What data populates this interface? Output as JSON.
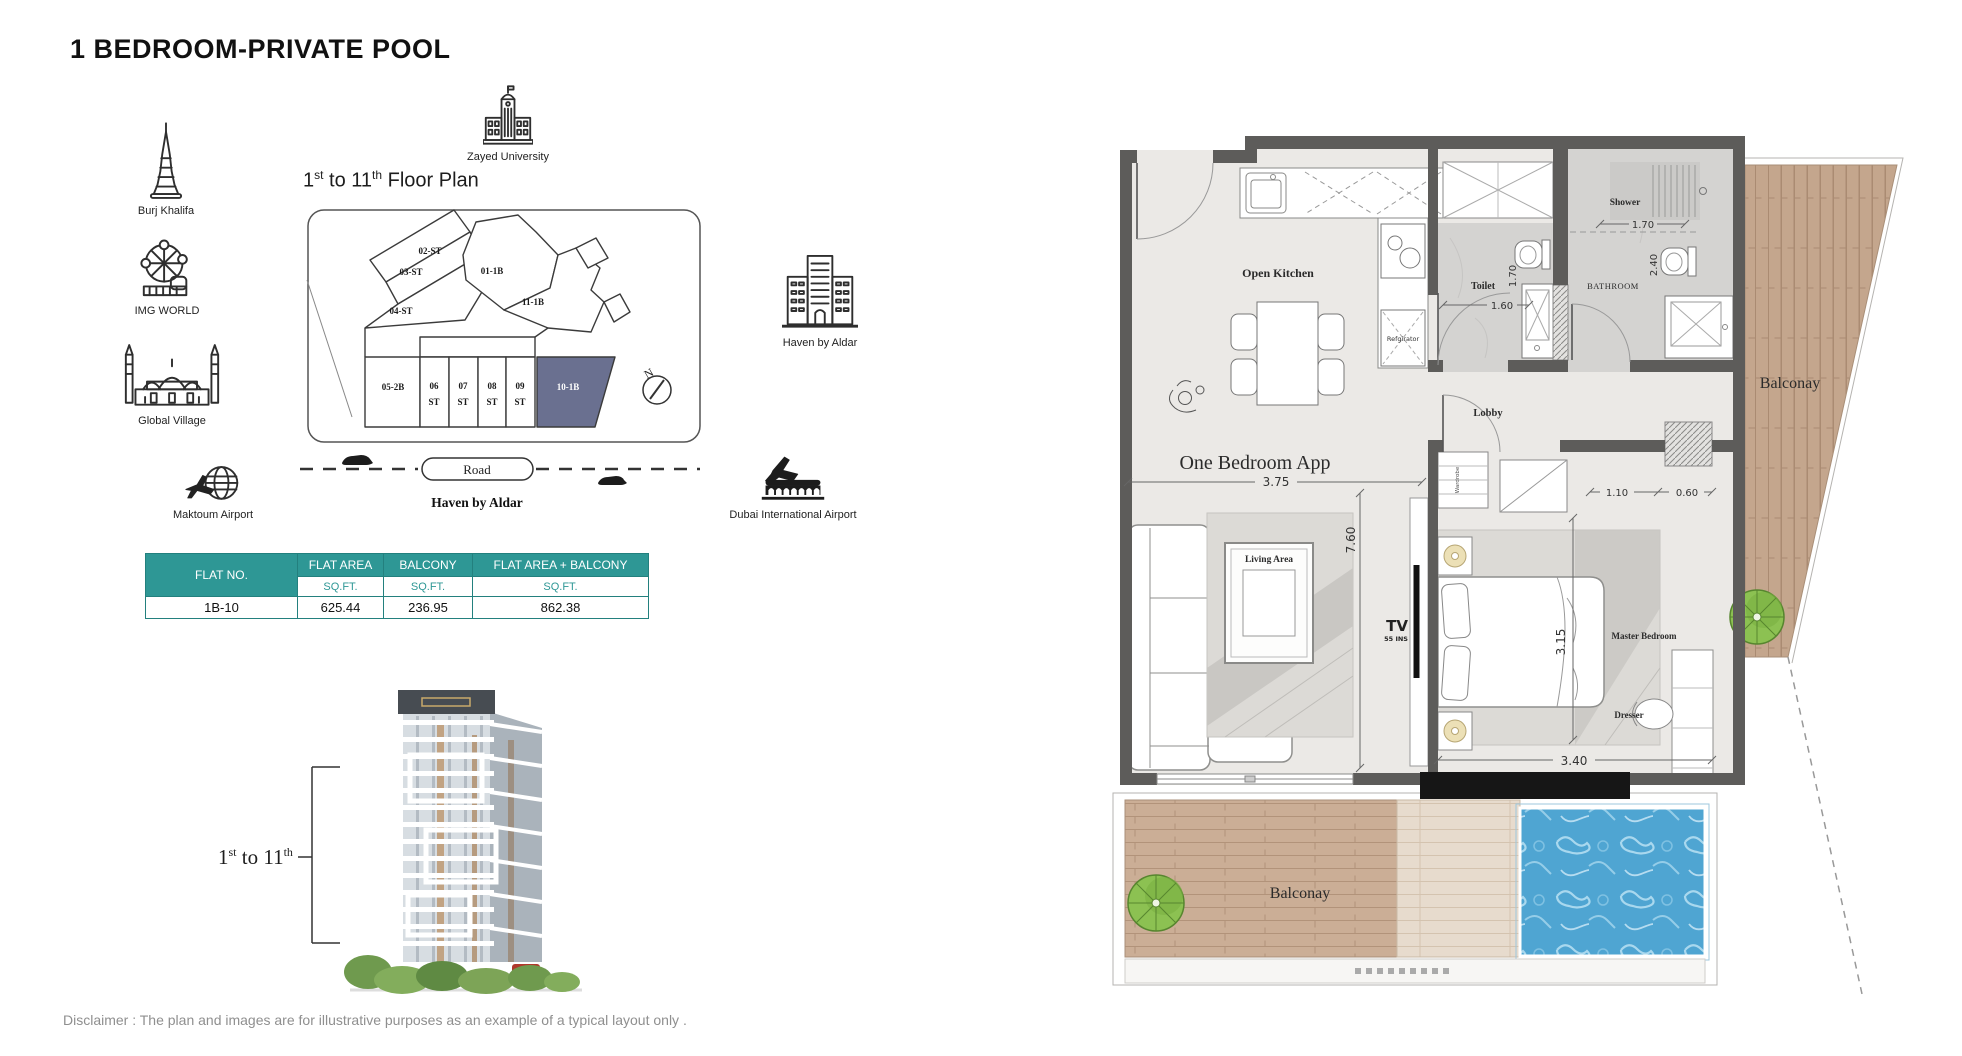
{
  "page": {
    "title": "1 BEDROOM-PRIVATE POOL",
    "disclaimer": "Disclaimer : The plan and images are for illustrative purposes as an example of a typical layout only ."
  },
  "colors": {
    "table_header": "#2E9795",
    "unit_highlight": "#6a7090",
    "pool": "#4fa5d2",
    "wall": "#5d5c5a",
    "deck_wood": "#cbae96"
  },
  "landmarks": {
    "burj_khalifa": "Burj Khalifa",
    "img_world": "IMG WORLD",
    "global_village": "Global Village",
    "maktoum_airport": "Maktoum Airport",
    "zayed_university": "Zayed University",
    "haven_building": "Haven by Aldar",
    "dubai_airport": "Dubai International Airport"
  },
  "key_plan": {
    "heading": {
      "n1": "1",
      "s1": "st",
      "mid": " to 11",
      "s2": "th",
      "rest": " Floor Plan"
    },
    "units": {
      "u02": "02-ST",
      "u03": "03-ST",
      "u04": "04-ST",
      "u01": "01-1B",
      "u11": "11-1B",
      "u05": "05-2B",
      "u06": "06",
      "u07": "07",
      "u08": "08",
      "u09": "09",
      "st": "ST",
      "u10": "10-1B"
    },
    "compass": "N",
    "road": "Road",
    "project": "Haven by Aldar"
  },
  "table": {
    "headers": [
      "FLAT NO.",
      "FLAT AREA",
      "BALCONY",
      "FLAT AREA + BALCONY"
    ],
    "unit_label": "SQ.FT.",
    "row": {
      "flat_no": "1B-10",
      "flat_area": "625.44",
      "balcony": "236.95",
      "total": "862.38"
    }
  },
  "building_render": {
    "range": {
      "n1": "1",
      "s1": "st",
      "mid": " to 11",
      "s2": "th"
    }
  },
  "floor_plan": {
    "labels": {
      "open_kitchen": "Open Kitchen",
      "refrigerator": "Refgirator",
      "toilet": "Toilet",
      "shower": "Shower",
      "bathroom": "BATHROOM",
      "lobby": "Lobby",
      "apartment": "One Bedroom App",
      "living_area": "Living Area",
      "tv": "TV",
      "tv_size": "55 INS",
      "wardrobe": "Wardrobe",
      "master_bedroom": "Master Bedroom",
      "dresser": "Dresser",
      "balcony_bottom": "Balconay",
      "balcony_right": "Balconay"
    },
    "dims": {
      "overall_width": "3.75",
      "overall_depth": "7.60",
      "shower_width": "1.70",
      "toilet_width": "1.60",
      "toilet_depth": "1.70",
      "bathroom_depth": "2.40",
      "bedroom_width": "3.40",
      "bedroom_depth": "3.15",
      "wardrobe_width": "1.10",
      "gap_width": "0.60"
    }
  }
}
